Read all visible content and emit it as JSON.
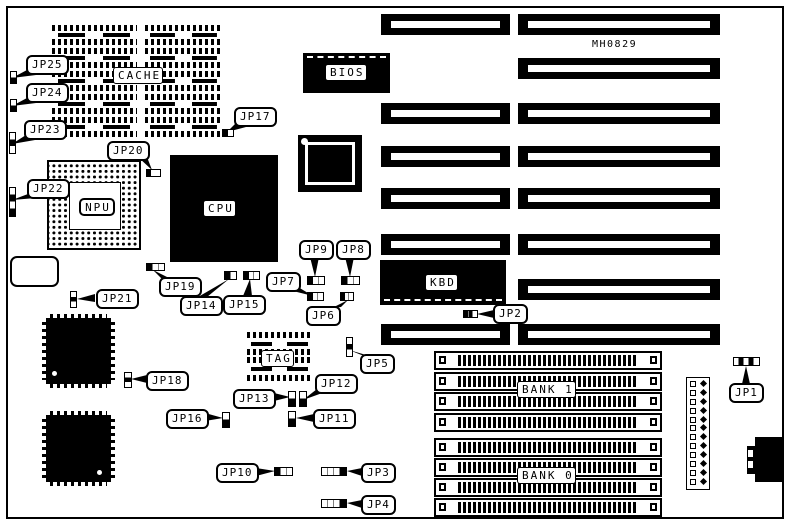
{
  "board": {
    "id_label": "MH0829",
    "chips": {
      "cache": "CACHE",
      "bios": "BIOS",
      "npu": "NPU",
      "cpu": "CPU",
      "kbd": "KBD",
      "tag": "TAG",
      "bank1": "BANK 1",
      "bank0": "BANK 0"
    },
    "jumpers": {
      "jp1": "JP1",
      "jp2": "JP2",
      "jp3": "JP3",
      "jp4": "JP4",
      "jp5": "JP5",
      "jp6": "JP6",
      "jp7": "JP7",
      "jp8": "JP8",
      "jp9": "JP9",
      "jp10": "JP10",
      "jp11": "JP11",
      "jp12": "JP12",
      "jp13": "JP13",
      "jp14": "JP14",
      "jp15": "JP15",
      "jp16": "JP16",
      "jp17": "JP17",
      "jp18": "JP18",
      "jp19": "JP19",
      "jp20": "JP20",
      "jp21": "JP21",
      "jp22": "JP22",
      "jp23": "JP23",
      "jp24": "JP24",
      "jp25": "JP25"
    }
  }
}
